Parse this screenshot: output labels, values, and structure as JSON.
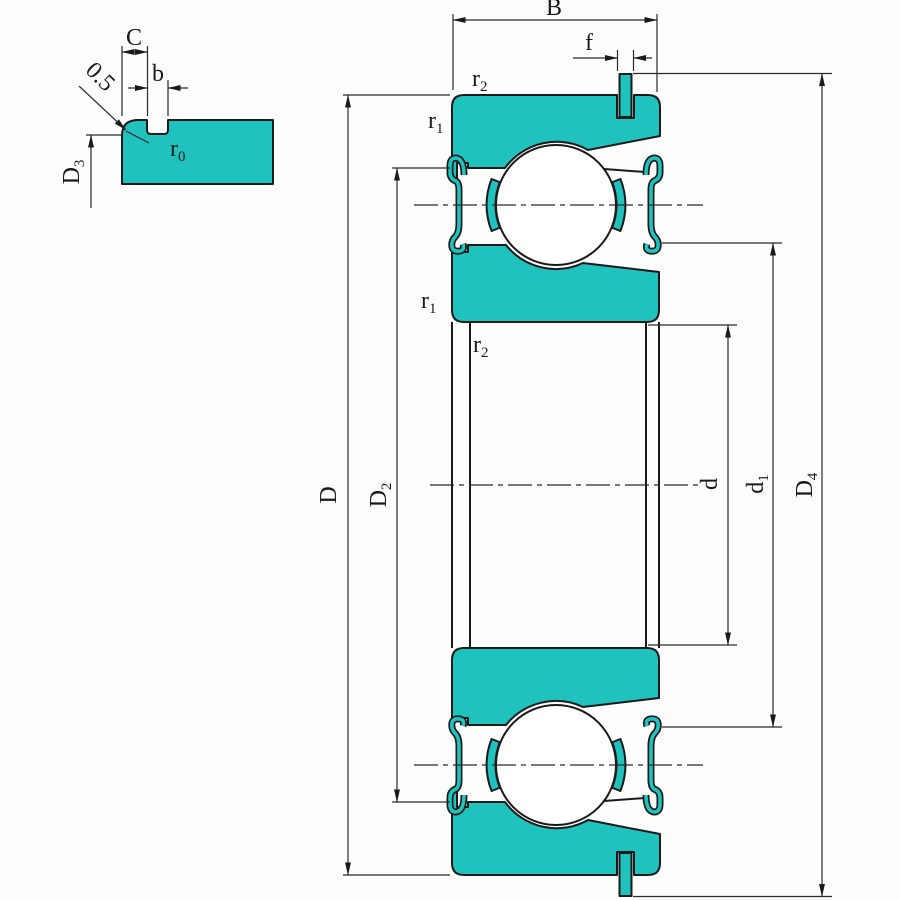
{
  "drawing_title": "deep groove ball bearing with shields and snap ring - dimensioned cross-section",
  "colors": {
    "ring_fill": "#1fc2bd",
    "outline": "#1a1a1a",
    "dim_line": "#2a2a2a",
    "background": "#fdfdfd"
  },
  "detail_view": {
    "land_width_label": "C",
    "groove_width_label": "b",
    "chamfer_value_label": "0.5",
    "groove_corner_radius_label": {
      "base": "r",
      "sub": "0"
    },
    "groove_diameter_label": {
      "base": "D",
      "sub": "3"
    }
  },
  "main_view": {
    "width_label": "B",
    "snap_ring_width_label": "f",
    "chamfer_outer_top_label": {
      "base": "r",
      "sub": "2"
    },
    "chamfer_outer_side_label": {
      "base": "r",
      "sub": "1"
    },
    "chamfer_inner_side_label": {
      "base": "r",
      "sub": "1"
    },
    "chamfer_inner_bottom_label": {
      "base": "r",
      "sub": "2"
    },
    "outer_diameter_label": {
      "base": "D",
      "sub": ""
    },
    "shield_recess_diameter_label": {
      "base": "D",
      "sub": "2"
    },
    "bore_diameter_label": {
      "base": "d",
      "sub": ""
    },
    "shoulder_diameter_label": {
      "base": "d",
      "sub": "1"
    },
    "snap_ring_diameter_label": {
      "base": "D",
      "sub": "4"
    }
  }
}
